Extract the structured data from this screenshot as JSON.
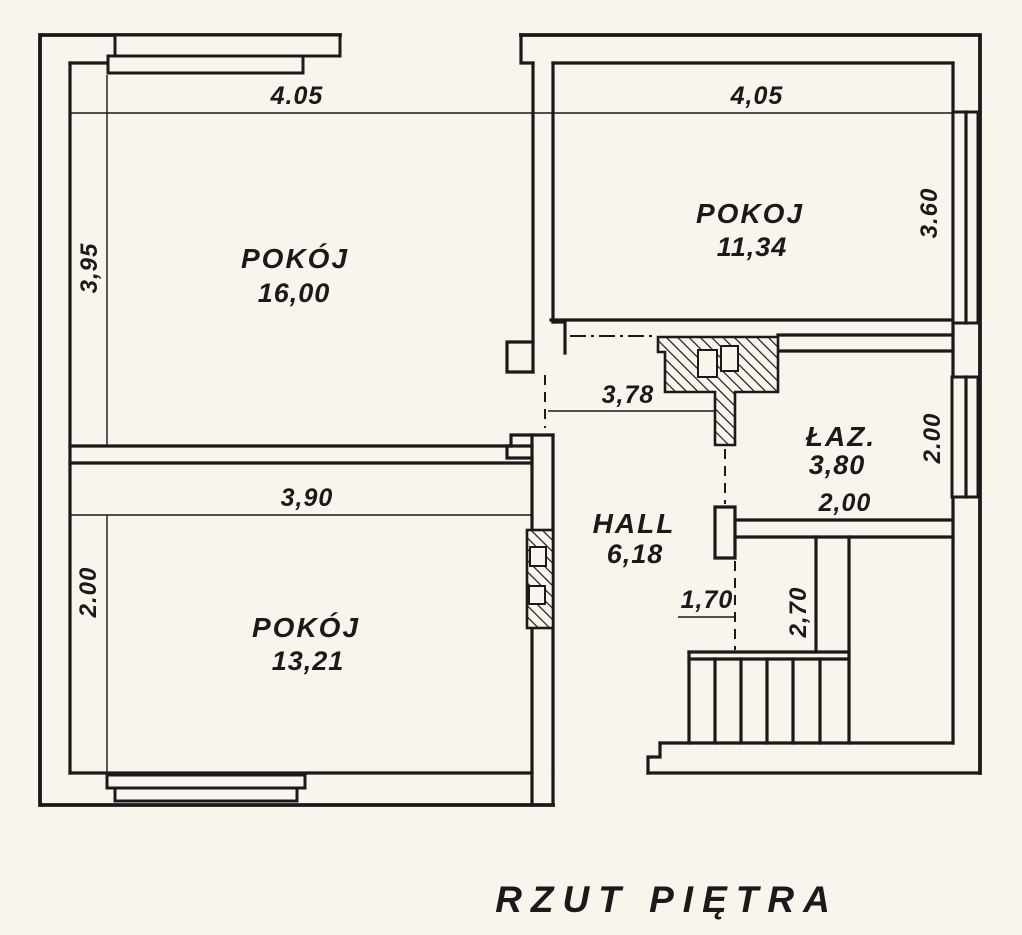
{
  "title": "RZUT PIĘTRA",
  "rooms": {
    "pokoj1": {
      "name": "POKÓJ",
      "area": "16,00"
    },
    "pokoj2": {
      "name": "POKOJ",
      "area": "11,34"
    },
    "laz": {
      "name": "ŁAZ.",
      "area": "3,80"
    },
    "hall": {
      "name": "HALL",
      "area": "6,18"
    },
    "pokoj3": {
      "name": "POKÓJ",
      "area": "13,21"
    }
  },
  "dimensions": {
    "pokoj1_width": "4.05",
    "pokoj1_height": "3,95",
    "pokoj2_width": "4,05",
    "pokoj2_height": "3.60",
    "hall_width": "3,78",
    "laz_height": "2.00",
    "laz_width": "2,00",
    "pokoj3_width": "3,90",
    "pokoj3_height": "2.00",
    "stairs_width": "1,70",
    "stairs_depth": "2,70"
  },
  "colors": {
    "background": "#f9f5ed",
    "line": "#1a1a1a"
  }
}
